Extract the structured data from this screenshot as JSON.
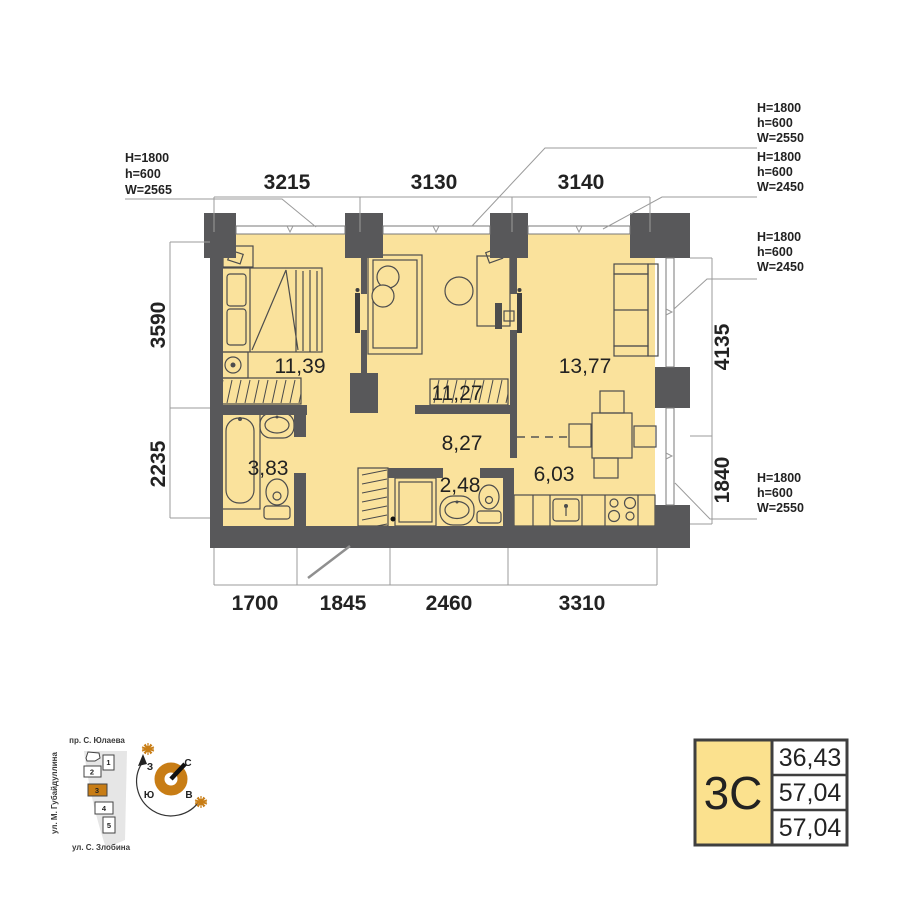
{
  "plan": {
    "rooms": [
      {
        "id": "bedroom-1",
        "area": "11,39"
      },
      {
        "id": "bedroom-2",
        "area": "11,27"
      },
      {
        "id": "living-room",
        "area": "13,77"
      },
      {
        "id": "hallway",
        "area": "8,27"
      },
      {
        "id": "bathroom",
        "area": "3,83"
      },
      {
        "id": "wc",
        "area": "2,48"
      },
      {
        "id": "kitchen",
        "area": "6,03"
      }
    ],
    "dimensions": {
      "top": [
        "3215",
        "3130",
        "3140"
      ],
      "bottom": [
        "1700",
        "1845",
        "2460",
        "3310"
      ],
      "left": [
        "3590",
        "2235"
      ],
      "right": [
        "4135",
        "1840"
      ]
    },
    "window_annotations": [
      {
        "position": "top-left",
        "lines": [
          "H=1800",
          "h=600",
          "W=2565"
        ]
      },
      {
        "position": "top-right-upper",
        "lines": [
          "H=1800",
          "h=600",
          "W=2550"
        ]
      },
      {
        "position": "top-right-lower",
        "lines": [
          "H=1800",
          "h=600",
          "W=2450"
        ]
      },
      {
        "position": "right-middle",
        "lines": [
          "H=1800",
          "h=600",
          "W=2450"
        ]
      },
      {
        "position": "right-bottom",
        "lines": [
          "H=1800",
          "h=600",
          "W=2550"
        ]
      }
    ]
  },
  "legend": {
    "type": "3С",
    "values": [
      "36,43",
      "57,04",
      "57,04"
    ]
  },
  "site_plan": {
    "streets": {
      "top": "пр. С. Юлаева",
      "left": "ул. М. Губайдуллина",
      "bottom": "ул. С. Злобина"
    },
    "buildings": [
      "1",
      "2",
      "3",
      "4",
      "5"
    ],
    "highlighted_building": "3"
  },
  "compass": {
    "north": "С",
    "south": "Ю",
    "west": "З",
    "east": "В"
  },
  "colors": {
    "room_fill": "#fae29c",
    "wall": "#58585a",
    "accent": "#c87d15",
    "legend_fill": "#fbe18e"
  }
}
